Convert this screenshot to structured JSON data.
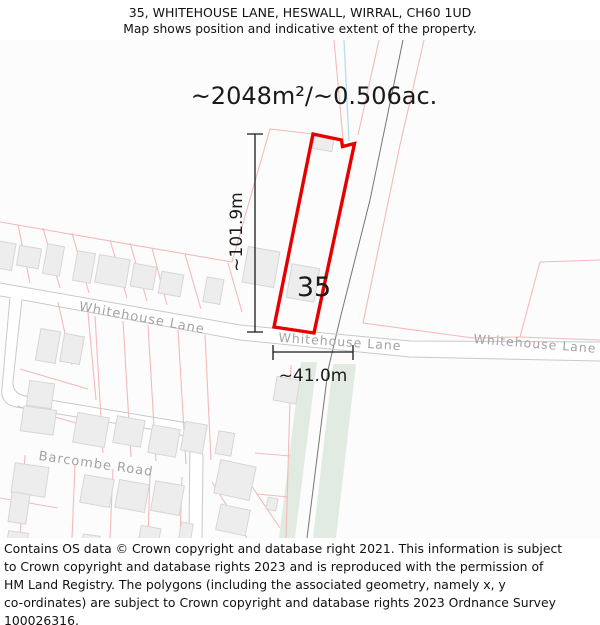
{
  "header": {
    "line1": "35, WHITEHOUSE LANE, HESWALL, WIRRAL, CH60 1UD",
    "line2": "Map shows position and indicative extent of the property."
  },
  "map": {
    "area_label": "~2048m²/~0.506ac.",
    "plot_label": "35",
    "height_label": "~101.9m",
    "width_label": "~41.0m",
    "streets": {
      "whitehouse_west": "Whitehouse Lane",
      "whitehouse_mid": "Whitehouse Lane",
      "whitehouse_east": "Whitehouse Lane",
      "barcombe": "Barcombe Road"
    }
  },
  "colors": {
    "plot_outline": "#e60000",
    "parcel_line": "#f5b9b9",
    "building_fill": "#ededed",
    "building_stroke": "#d6d6d6",
    "road_line": "#c9c9c9",
    "street_text": "#a3a3a3",
    "green_strip": "#e2ebe1",
    "track_line": "#757575",
    "water_line": "#b9dcee",
    "dimension": "#1a1a1a"
  },
  "footer": {
    "lines": [
      "Contains OS data © Crown copyright and database right 2021. This information is subject",
      "to Crown copyright and database rights 2023 and is reproduced with the permission of",
      "HM Land Registry. The polygons (including the associated geometry, namely x, y",
      "co-ordinates) are subject to Crown copyright and database rights 2023 Ordnance Survey",
      "100026316."
    ]
  }
}
